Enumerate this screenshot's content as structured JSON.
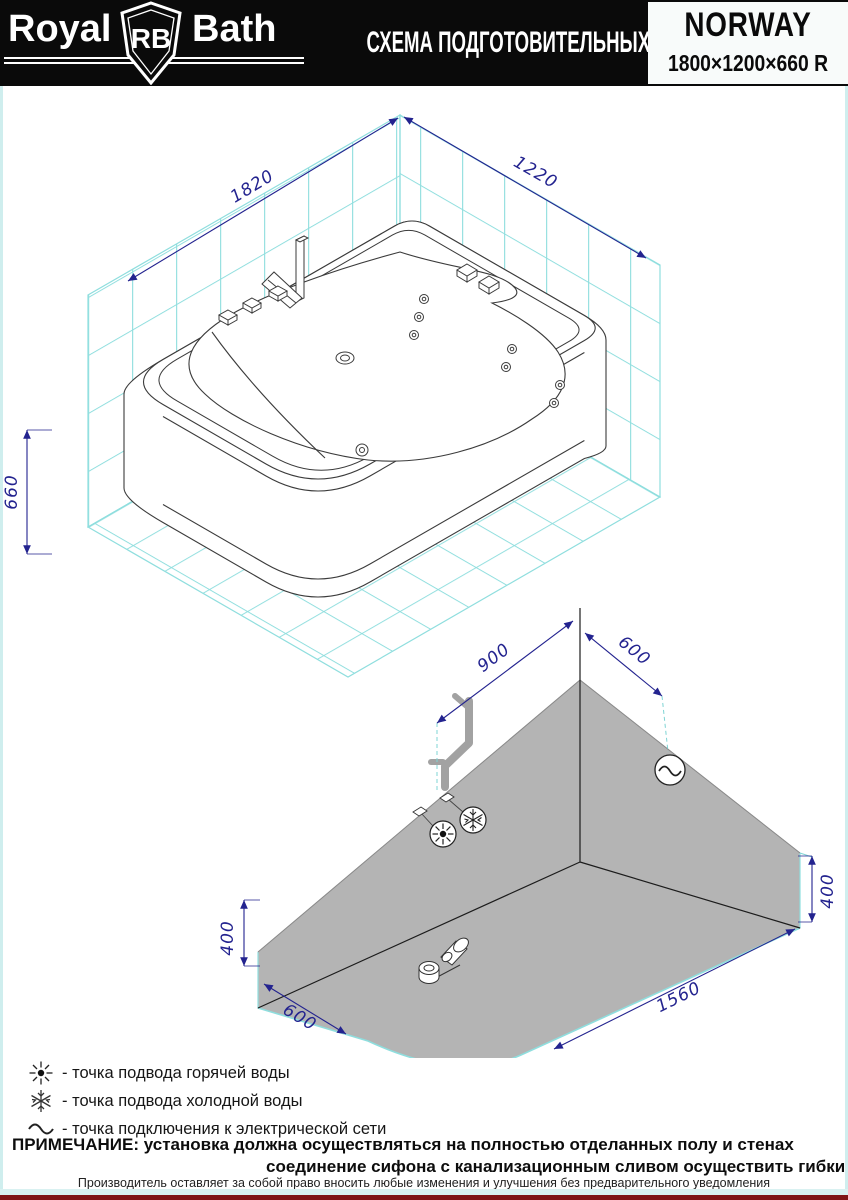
{
  "header": {
    "brand": {
      "royal": "Royal",
      "rb": "RB",
      "bath": "Bath"
    },
    "title": "СХЕМА ПОДГОТОВИТЕЛЬНЫХ РАБОТ",
    "model": "NORWAY",
    "size": "1800×1200×660 R"
  },
  "top_drawing": {
    "dims": {
      "length": "1820",
      "width": "1220",
      "height": "660"
    }
  },
  "bottom_drawing": {
    "dims": {
      "wall_left": "900",
      "wall_right": "600",
      "height_left": "400",
      "height_right": "400",
      "floor_left": "600",
      "floor_right": "1560"
    }
  },
  "legend": {
    "items": [
      {
        "icon": "hot-water-icon",
        "label": "- точка подвода горячей воды"
      },
      {
        "icon": "cold-water-icon",
        "label": "- точка подвода холодной воды"
      },
      {
        "icon": "electrical-icon",
        "label": "- точка подключения к электрической сети"
      }
    ]
  },
  "note": {
    "line1": "ПРИМЕЧАНИЕ: установка должна осуществляться на полностью отделанных полу и стенах",
    "line2": "соединение сифона с канализационным сливом осуществить гибким шлангом"
  },
  "footer": "Производитель оставляет за собой право вносить любые изменения и улучшения без предварительного уведомления",
  "colors": {
    "tile_cyan": "#8fdede",
    "dimension_blue": "#23238f",
    "zone_gray": "#b4b4b4",
    "footer_red": "#7f1416",
    "header_black": "#0a0a0a"
  }
}
